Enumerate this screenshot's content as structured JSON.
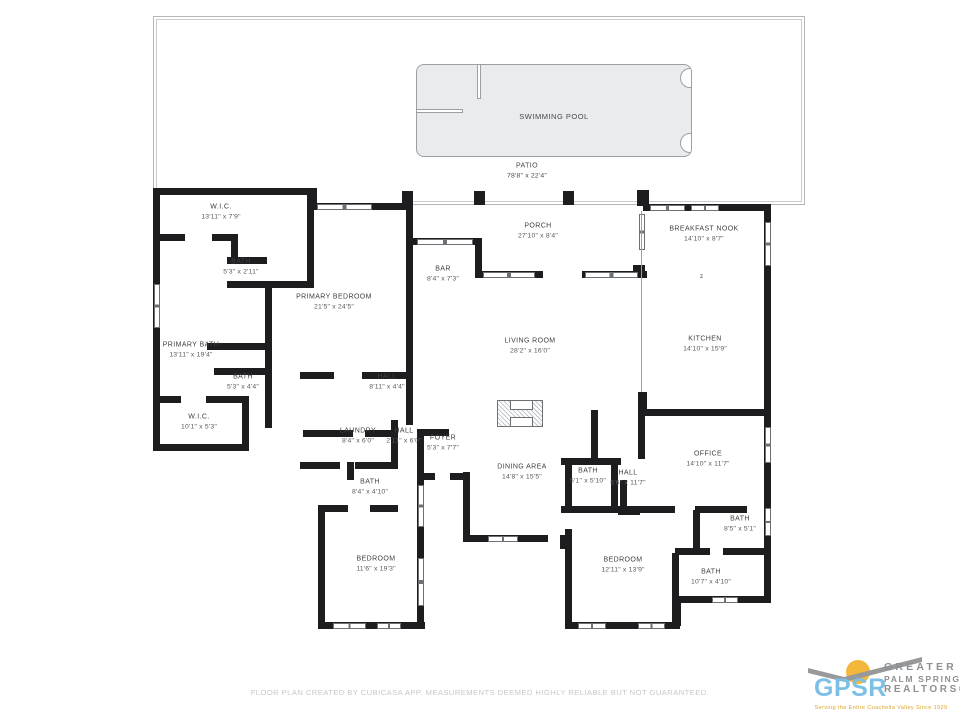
{
  "outdoor": {
    "pool": {
      "label": "SWIMMING POOL",
      "x": 553,
      "y": 116
    },
    "patio": {
      "label": "PATIO",
      "dims": "78'8\" x 22'4\"",
      "x": 527,
      "y": 165
    }
  },
  "rooms": [
    {
      "label": "W.I.C.",
      "dims": "13'11\" x 7'9\"",
      "x": 221,
      "y": 212
    },
    {
      "label": "BATH",
      "dims": "5'3\" x 2'11\"",
      "x": 241,
      "y": 267
    },
    {
      "label": "PRIMARY BEDROOM",
      "dims": "21'5\" x 24'5\"",
      "x": 334,
      "y": 302
    },
    {
      "label": "PRIMARY BATH",
      "dims": "13'11\" x 19'4\"",
      "x": 191,
      "y": 350
    },
    {
      "label": "BATH",
      "dims": "5'3\" x 4'4\"",
      "x": 243,
      "y": 382
    },
    {
      "label": "W.I.C.",
      "dims": "10'1\" x 5'3\"",
      "x": 199,
      "y": 422
    },
    {
      "label": "HALL",
      "dims": "8'11\" x 4'4\"",
      "x": 387,
      "y": 382
    },
    {
      "label": "LAUNDRY",
      "dims": "8'4\" x 6'0\"",
      "x": 358,
      "y": 436
    },
    {
      "label": "HALL",
      "dims": "2'11\" x 6'0\"",
      "x": 404,
      "y": 436
    },
    {
      "label": "FOYER",
      "dims": "5'3\" x 7'7\"",
      "x": 443,
      "y": 443
    },
    {
      "label": "BATH",
      "dims": "8'4\" x 4'10\"",
      "x": 370,
      "y": 487
    },
    {
      "label": "BEDROOM",
      "dims": "11'6\" x 19'3\"",
      "x": 376,
      "y": 564
    },
    {
      "label": "PORCH",
      "dims": "27'10\" x 8'4\"",
      "x": 538,
      "y": 231
    },
    {
      "label": "BAR",
      "dims": "8'4\" x 7'3\"",
      "x": 443,
      "y": 274
    },
    {
      "label": "LIVING ROOM",
      "dims": "28'2\" x 16'0\"",
      "x": 530,
      "y": 346
    },
    {
      "label": "DINING AREA",
      "dims": "14'8\" x 15'5\"",
      "x": 522,
      "y": 472
    },
    {
      "label": "BREAKFAST NOOK",
      "dims": "14'10\" x 8'7\"",
      "x": 704,
      "y": 234
    },
    {
      "label": "KITCHEN",
      "dims": "14'10\" x 15'9\"",
      "x": 705,
      "y": 344
    },
    {
      "label": "OFFICE",
      "dims": "14'10\" x 11'7\"",
      "x": 708,
      "y": 459
    },
    {
      "label": "BATH",
      "dims": "5'1\" x 5'10\"",
      "x": 588,
      "y": 476
    },
    {
      "label": "HALL",
      "dims": "5'6\" x 11'7\"",
      "x": 628,
      "y": 478
    },
    {
      "label": "BATH",
      "dims": "8'5\" x 5'1\"",
      "x": 740,
      "y": 524
    },
    {
      "label": "BEDROOM",
      "dims": "12'11\" x 13'9\"",
      "x": 623,
      "y": 565
    },
    {
      "label": "BATH",
      "dims": "10'7\" x 4'10\"",
      "x": 711,
      "y": 577
    }
  ],
  "footer": "FLOOR PLAN CREATED BY CUBICASA APP. MEASUREMENTS DEEMED HIGHLY RELIABLE BUT NOT GUARANTEED.",
  "logo": {
    "acronym": "GPSR",
    "line1": "GREATER",
    "line2": "PALM SPRINGS",
    "line3": "REALTORS®",
    "tagline": "Serving the Entire Coachella Valley Since 1929",
    "colors": {
      "blue": "#7cc0e6",
      "gold": "#f3b73a",
      "gray": "#8b9094"
    }
  },
  "colors": {
    "wall": "#1d1d1f",
    "pool_fill": "#e9ebed",
    "outline": "#9aa0a6"
  }
}
